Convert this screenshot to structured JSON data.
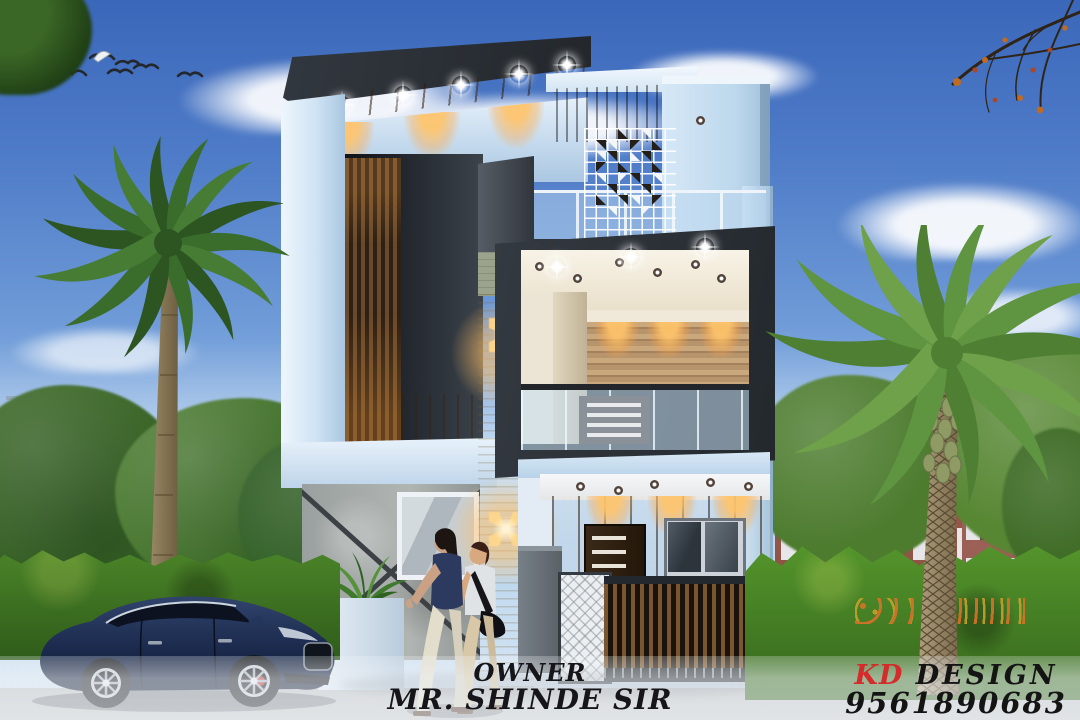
{
  "caption": {
    "owner_label": "OWNER",
    "owner_name": "MR. SHINDE SIR"
  },
  "branding": {
    "initials": "KD",
    "name": "DESIGN",
    "phone": "9561890683",
    "initials_color": "#d42b2b",
    "text_color": "#141414"
  },
  "palette": {
    "sky_top": "#3b67ba",
    "sky_horizon": "#d8e6f2",
    "wall_light_blue": "#cde2f4",
    "frame_charcoal": "#2d3339",
    "soffit_wood": "#8a5a2e",
    "hedge_green": "#4f8c2c",
    "road_grey": "#a7aaae",
    "car_navy": "#1b2a4d",
    "downlight_warm": "#ffbe64"
  },
  "scene_icons": {
    "birds": "flying-birds-icon",
    "palm": "palm-tree-icon",
    "wall_lamp": "butterfly-wall-light-icon",
    "downlight": "ceiling-downlight-icon"
  }
}
